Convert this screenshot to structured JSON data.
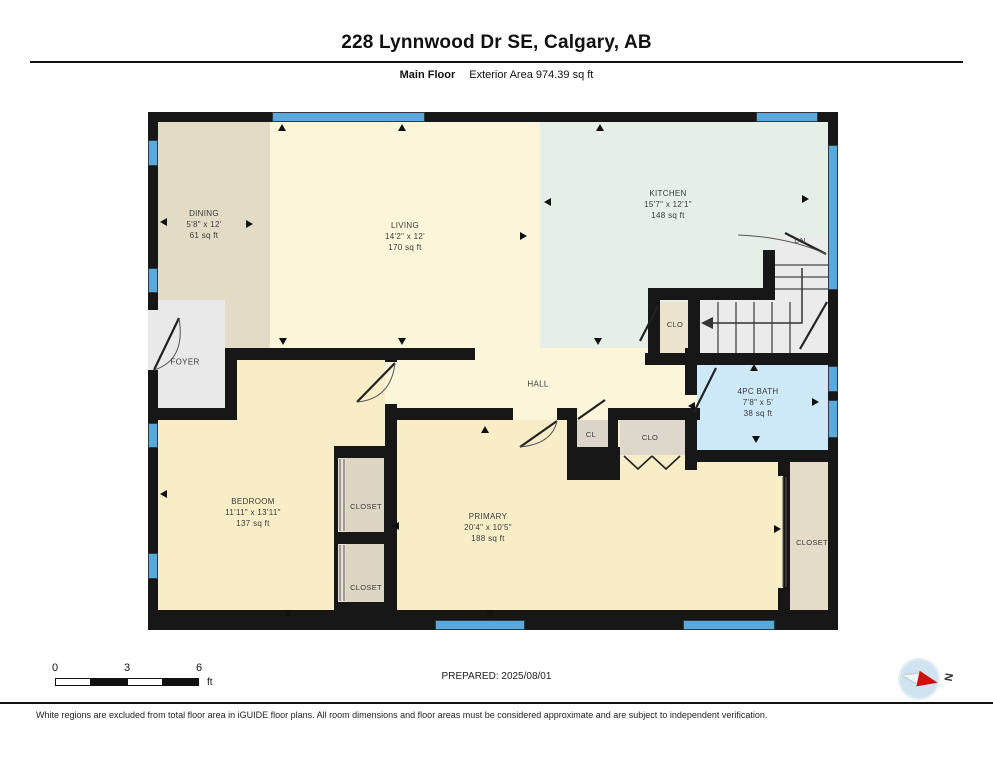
{
  "header": {
    "address": "228 Lynnwood Dr SE, Calgary, AB",
    "floor_label": "Main Floor",
    "area_label": "Exterior Area 974.39 sq ft"
  },
  "rooms": {
    "dining": {
      "name": "DINING",
      "dims": "5'8\" x 12'",
      "area": "61 sq ft"
    },
    "living": {
      "name": "LIVING",
      "dims": "14'2\" x 12'",
      "area": "170 sq ft"
    },
    "kitchen": {
      "name": "KITCHEN",
      "dims": "15'7\" x 12'1\"",
      "area": "148 sq ft"
    },
    "foyer": {
      "name": "FOYER"
    },
    "hall": {
      "name": "HALL"
    },
    "stair_closet": {
      "name": "CLO"
    },
    "stair_direction": {
      "name": "DN"
    },
    "bath": {
      "name": "4PC BATH",
      "dims": "7'8\" x 5'",
      "area": "38 sq ft"
    },
    "bedroom": {
      "name": "BEDROOM",
      "dims": "11'11\" x 13'11\"",
      "area": "137 sq ft"
    },
    "bedroom_closet_top": {
      "name": "CLOSET"
    },
    "bedroom_closet_bottom": {
      "name": "CLOSET"
    },
    "primary": {
      "name": "PRIMARY",
      "dims": "20'4\" x 10'5\"",
      "area": "188 sq ft"
    },
    "hall_closet_small": {
      "name": "CL"
    },
    "hall_closet": {
      "name": "CLO"
    },
    "primary_closet": {
      "name": "CLOSET"
    }
  },
  "scale_bar": {
    "tick0": "0",
    "tick3": "3",
    "tick6": "6",
    "unit": "ft"
  },
  "footer": {
    "prepared": "PREPARED: 2025/08/01",
    "disclaimer": "White regions are excluded from total floor area in iGUIDE floor plans. All room dimensions and floor areas must be considered approximate and are subject to independent verification.",
    "compass_label": "N"
  },
  "colors": {
    "wall": "#171717",
    "window": "#5ba9da",
    "dining_floor": "#e2dbc6",
    "living_floor": "#fbf5da",
    "kitchen_floor": "#e5efe8",
    "bedroom_floor": "#f8edc7",
    "bath_floor": "#cde8f7",
    "closet_floor": "#ddd6c5",
    "stairs_floor": "#ebebeb",
    "compass_needle": "#cc1111"
  }
}
